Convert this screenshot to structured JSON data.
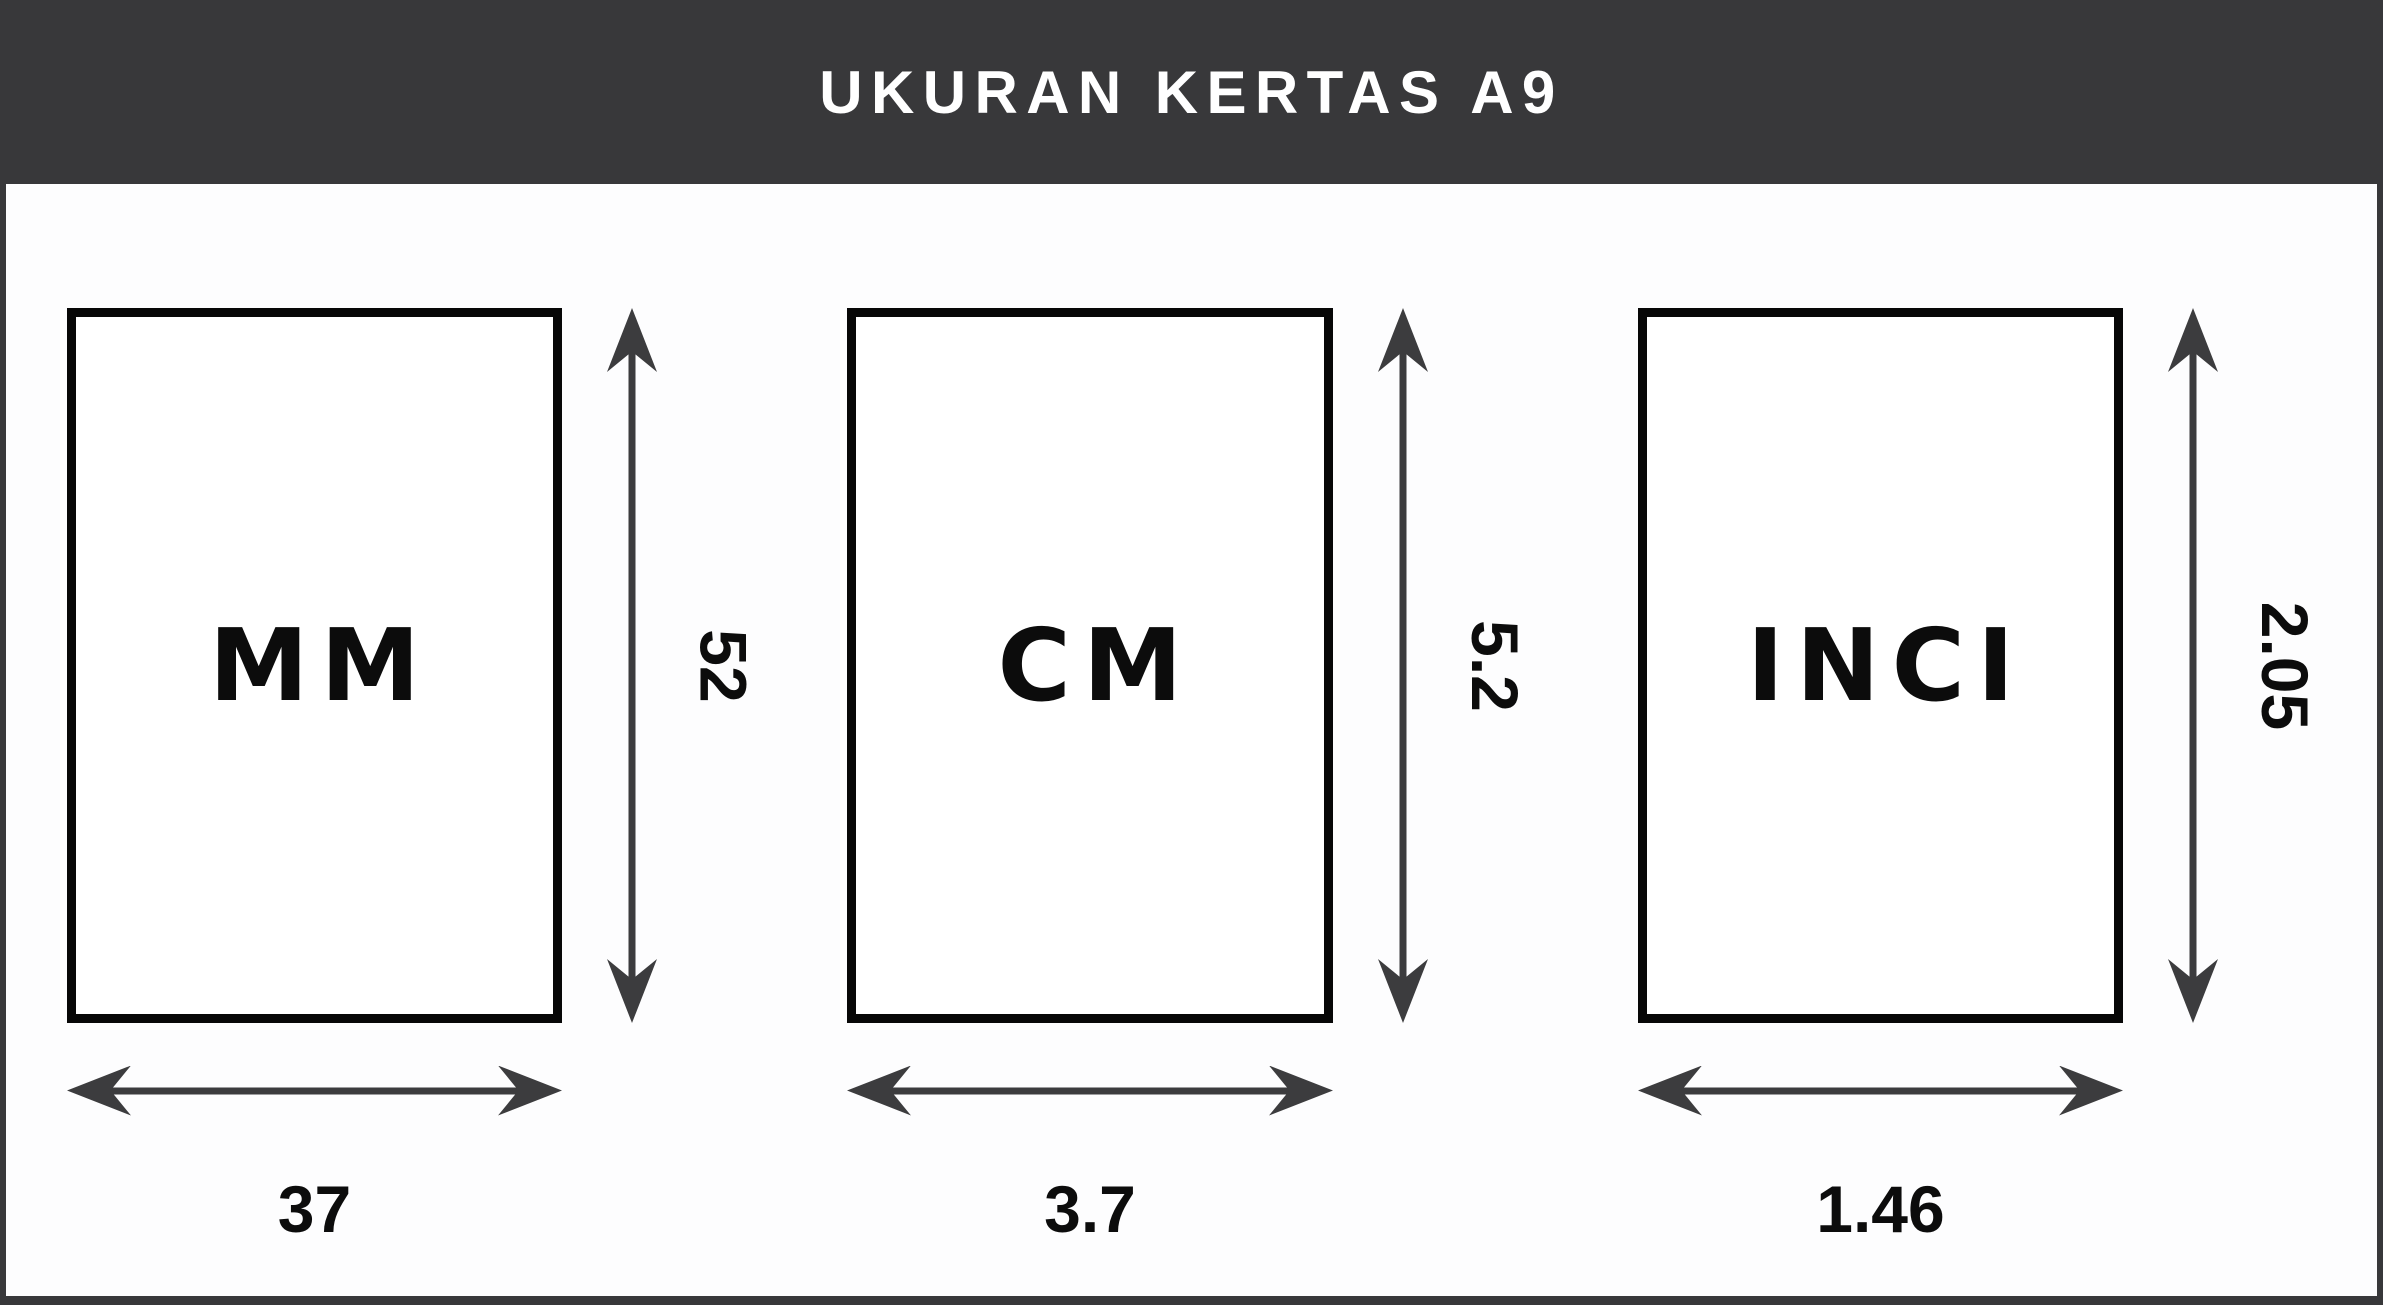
{
  "header": {
    "title": "UKURAN KERTAS A9"
  },
  "panels": [
    {
      "unit": "MM",
      "width": "37",
      "height": "52"
    },
    {
      "unit": "CM",
      "width": "3.7",
      "height": "5.2"
    },
    {
      "unit": "INCI",
      "width": "1.46",
      "height": "2.05"
    }
  ],
  "colors": {
    "header_bg": "#38383a",
    "frame": "#38383a",
    "text_light": "#ffffff",
    "text_dark": "#0c0c0c",
    "arrow": "#3c3c3e",
    "paper_bg": "#fdfdfe"
  }
}
